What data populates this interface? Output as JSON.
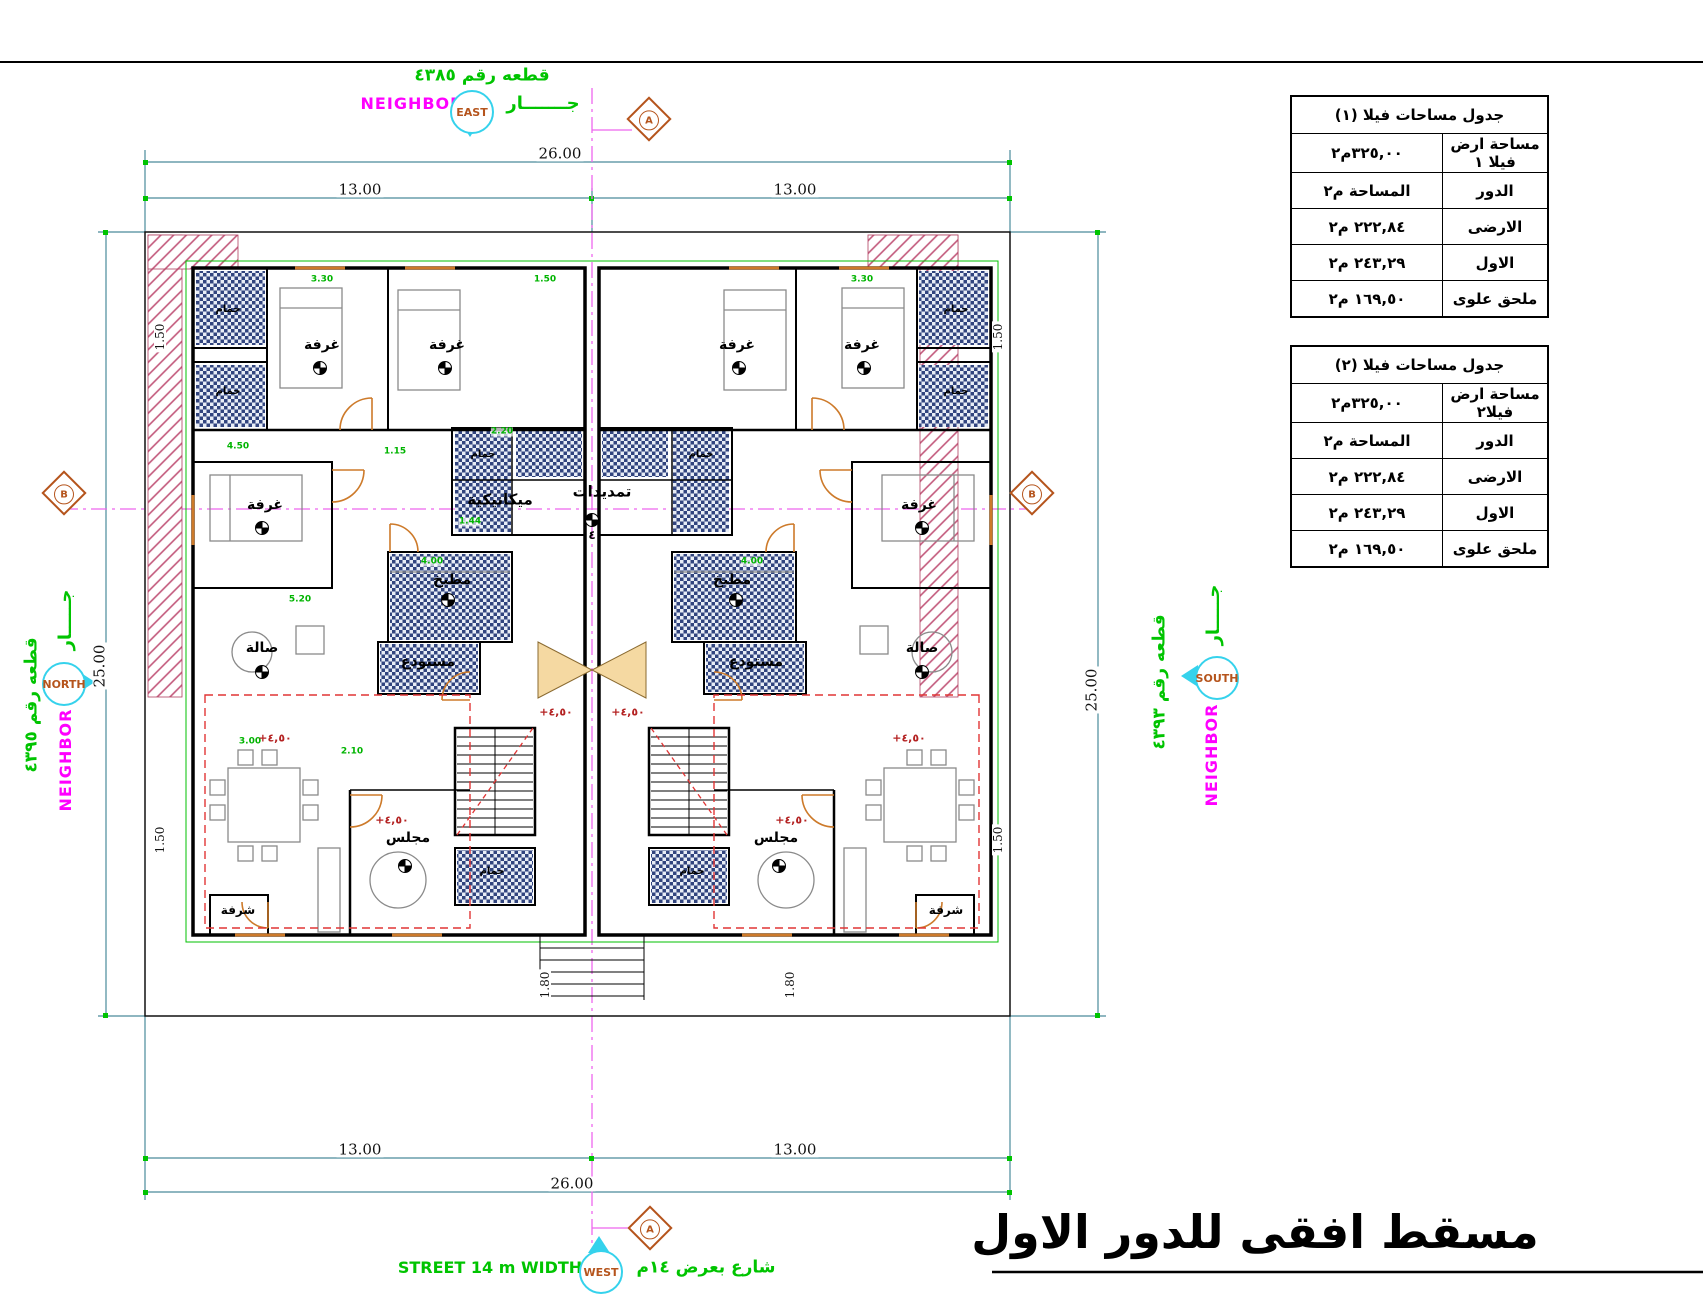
{
  "drawing_title": "مسقط افقى للدور الاول",
  "area_tables": [
    {
      "title": "جدول مساحات فيلا (١)",
      "rows": [
        {
          "label": "مساحة ارض فيلا ١",
          "value": "٣٢٥,٠٠م٢"
        },
        {
          "label": "الدور",
          "value": "المساحة م٢"
        },
        {
          "label": "الارضى",
          "value": "٢٢٢,٨٤ م٢"
        },
        {
          "label": "الاول",
          "value": "٢٤٣,٢٩ م٢"
        },
        {
          "label": "ملحق علوى",
          "value": "١٦٩,٥٠ م٢"
        }
      ]
    },
    {
      "title": "جدول مساحات فيلا (٢)",
      "rows": [
        {
          "label": "مساحة ارض فيلا٢",
          "value": "٣٢٥,٠٠م٢"
        },
        {
          "label": "الدور",
          "value": "المساحة م٢"
        },
        {
          "label": "الارضى",
          "value": "٢٢٢,٨٤ م٢"
        },
        {
          "label": "الاول",
          "value": "٢٤٣,٢٩ م٢"
        },
        {
          "label": "ملحق علوى",
          "value": "١٦٩,٥٠ م٢"
        }
      ]
    }
  ],
  "site": {
    "top": {
      "plot": "قطعه رقم ٤٣٨٥",
      "neighbor": "NEIGHBOR",
      "jar": "جـــــــار",
      "compass": "EAST"
    },
    "left": {
      "plot": "قطعه رقم ٤٣٩٥",
      "neighbor": "NEIGHBOR",
      "jar": "جـــــار",
      "compass": "NORTH"
    },
    "right": {
      "plot": "قطعه رقم ٤٣٩٣",
      "neighbor": "NEIGHBOR",
      "jar": "جـــــار",
      "compass": "SOUTH"
    },
    "bottom": {
      "street_en": "STREET 14 m WIDTH",
      "street_ar": "شارع بعرض ١٤م",
      "compass": "WEST"
    }
  },
  "section_markers": {
    "a": "A",
    "b": "B"
  },
  "dims": {
    "total_w": "26.00",
    "half_w": "13.00",
    "total_h": "25.00",
    "side_setback": "1.50",
    "front_setback": "1.80"
  },
  "rooms": {
    "bedroom": "غرفة",
    "bath": "حمام",
    "kitchen": "مطبخ",
    "hall": "صالة",
    "majlis": "مجلس",
    "store": "مستودع",
    "mechanical": "ميكانيكية",
    "plumbing": "تمديدات",
    "terrace": "شرفة",
    "shaft_no": "٤"
  },
  "levels": {
    "plus_450": "+٤,٥٠"
  },
  "inner_dims": [
    "4.50",
    "3.30",
    "1.50",
    "4.00",
    "2.20",
    "1.44",
    "5.20",
    "3.00",
    "1.15",
    "2.10"
  ]
}
